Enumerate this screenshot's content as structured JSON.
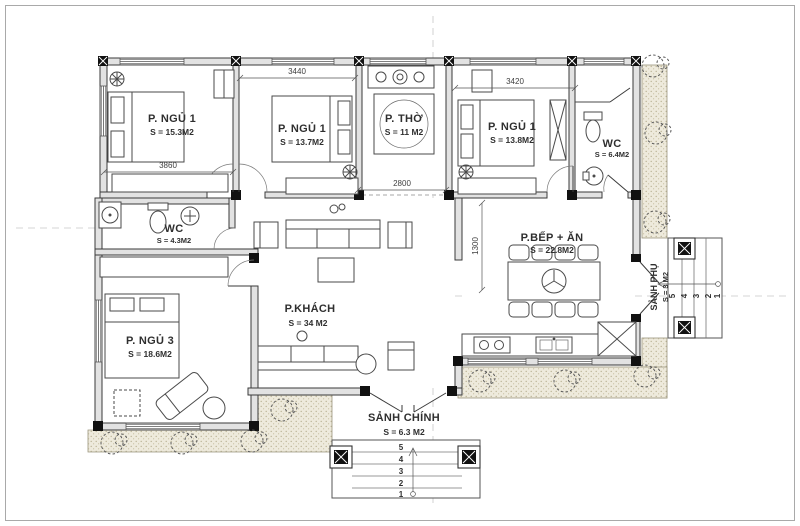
{
  "drawing": {
    "type": "house floor plan"
  },
  "colors": {
    "line": "#3a3a3a",
    "wall_fill": "#e2e2e2",
    "terrace_fill": "#eeeadc",
    "axis": "#c7c7c7"
  },
  "rooms": [
    {
      "name": "P. NGỦ 1",
      "area": "S = 15.3M2"
    },
    {
      "name": "P. NGỦ 1",
      "area": "S = 13.7M2"
    },
    {
      "name": "P. THỜ",
      "area": "S = 11 M2"
    },
    {
      "name": "P. NGỦ 1",
      "area": "S = 13.8M2"
    },
    {
      "name": "WC",
      "area": "S = 6.4M2"
    },
    {
      "name": "WC",
      "area": "S = 4.3M2"
    },
    {
      "name": "P. NGỦ 3",
      "area": "S = 18.6M2"
    },
    {
      "name": "P.KHÁCH",
      "area": "S = 34 M2"
    },
    {
      "name": "P.BẾP + ĂN",
      "area": "S = 22.8M2"
    },
    {
      "name": "SẢNH PHỤ",
      "area": "S = 3 M2"
    },
    {
      "name": "SẢNH CHÍNH",
      "area": "S = 6.3 M2"
    }
  ],
  "dimensions": {
    "bedroom2_width": "3440",
    "bedroom4_width": "3420",
    "bedroom1_width": "3860",
    "worship_width": "2800",
    "kitchen_setback": "1300"
  },
  "steps": {
    "main_entry": [
      "5",
      "4",
      "3",
      "2",
      "1"
    ],
    "side_entry": [
      "5",
      "4",
      "3",
      "2",
      "1"
    ]
  }
}
